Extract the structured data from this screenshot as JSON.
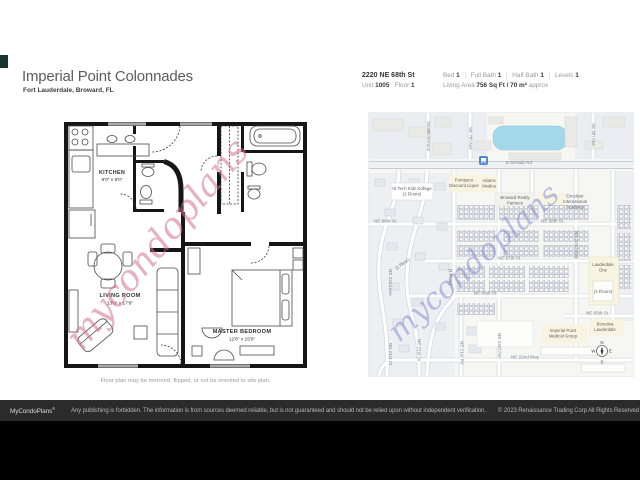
{
  "page": {
    "title": "Imperial Point Colonnades",
    "subtitle": "Fort Lauderdale, Broward, FL"
  },
  "facts": {
    "address": "2220 NE 68th St",
    "unit_label": "Unit",
    "unit_value": "1005",
    "floor_label": "Floor",
    "floor_value": "1",
    "bed_label": "Bed",
    "bed_value": "1",
    "full_bath_label": "Full Bath",
    "full_bath_value": "1",
    "half_bath_label": "Half Bath",
    "half_bath_value": "1",
    "levels_label": "Levels",
    "levels_value": "1",
    "living_area_label": "Living Area",
    "living_area_value": "756 Sq Ft",
    "living_area_metric": "/ 70 m²",
    "living_area_approx": "approx"
  },
  "floorplan": {
    "rooms": [
      {
        "name": "KITCHEN",
        "dims": "9'0\" x 9'0\""
      },
      {
        "name": "LIVING ROOM",
        "dims": "13'0\" x 17'8\""
      },
      {
        "name": "MASTER BEDROOM",
        "dims": "12'8\" x 15'0\""
      }
    ],
    "caption": "Floor plan may be mirrored, flipped, or not be oriented to site plan.",
    "watermark": "mycondoplans"
  },
  "map": {
    "watermark": "mycondoplans",
    "streets": {
      "e_mcnab": "E McNab Rd",
      "se_8th_terrace": "SE 8th Terrace",
      "se_7th_ave": "SE 7th Ave",
      "se_9th_ave": "SE 9th Ave",
      "ne_68th_a": "NE 68th St",
      "ne_68th_b": "NE 68th St",
      "ne_67th": "NE 67th St",
      "ne_66th": "NE 66th St",
      "ne_65th": "NE 65th St",
      "ne_22nd_way": "NE 22nd Way",
      "ne_22nd_way_v": "NE 22nd Way",
      "ne_23rd_ave": "NE 23rd Ave",
      "ne_22nd_ave": "NE 22nd Ave",
      "ne_21st_dr": "NE 21st Dr",
      "ne_21st_ct": "NE 21st Ct",
      "ne_21st_rd": "NE 21st Rd"
    },
    "pois": {
      "kollege_1": "Hi Tech Kidz Kollege",
      "kollege_2": "(2 Floors)",
      "pompano_1": "Pompano",
      "pompano_2": "Discount Liquor",
      "adams_1": "Adams",
      "adams_2": "Medica",
      "broward_1": "Broward Realty",
      "broward_2": "Partners",
      "excelsior_1": "Excelsior",
      "excelsior_2": "International",
      "excelsior_3": "Academy",
      "lauderdale_one_1": "Lauderdale",
      "lauderdale_one_2": "One",
      "four_floors": "(4 Floors)",
      "one_floor_a": "(1 Floor)",
      "one_floor_b": "(1 Floor)",
      "benetiva_1": "Benetiva",
      "benetiva_2": "Lauderdale",
      "imperial_medical_1": "Imperial Point",
      "imperial_medical_2": "Medical Group"
    },
    "compass": {
      "n": "N",
      "e": "E",
      "s": "S",
      "w": "W"
    }
  },
  "footer": {
    "brand": "MyCondoPlans",
    "reg": "®",
    "disclaimer": "Any publishing is forbidden. The information is from sources deemed reliable, but is not guaranteed and should not be relied upon without independent verification.",
    "copyright": "© 2023 Renaissance Trading Corp  All Rights Reserved"
  },
  "colors": {
    "plan_watermark": "#d4728f",
    "map_watermark": "#7b88cc",
    "water": "#a3d7ea",
    "poi_yellow": "#f8f4df",
    "footer_bg": "#2b2b2b",
    "teal_chip": "#18372f"
  }
}
